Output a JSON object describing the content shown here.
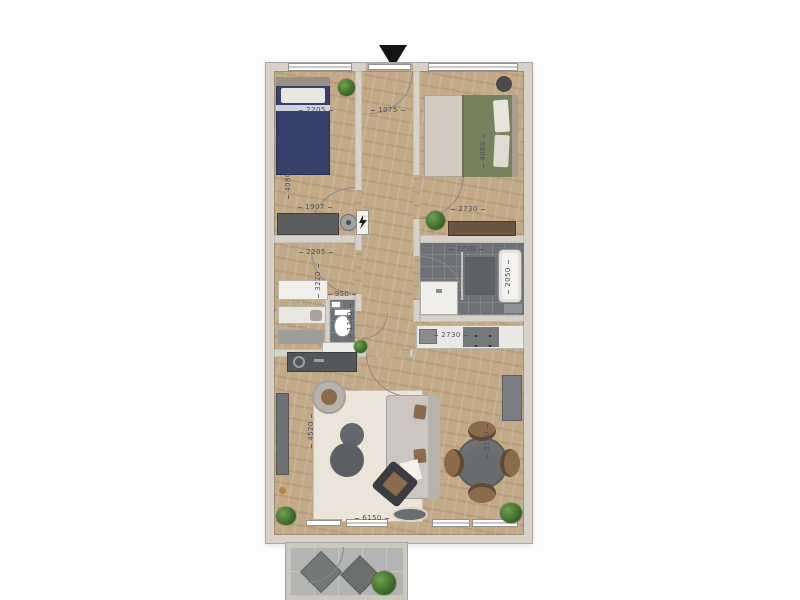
{
  "plan": {
    "title": "apartment-floor-plan",
    "dimension_labels": {
      "bedroom1_width": "2205",
      "bedroom1_depth": "4080",
      "bedroom1_desk_width": "1907",
      "hallway_width": "1075",
      "bedroom2_width": "2730",
      "bedroom2_depth": "4080",
      "utility_width": "2205",
      "utility_depth": "3220",
      "toilet_width": "950",
      "toilet_depth": "1300",
      "bathroom_width": "2730",
      "bathroom_depth": "2050",
      "kitchen_width": "2730",
      "living_width": "6150",
      "living_depth": "4520",
      "dining_depth": "3170"
    },
    "colors": {
      "wall": "#d6d2c9",
      "wood_floor": "#c2a987",
      "dark_tile": "#6e7176",
      "rug": "#ebe5d9",
      "bed_navy": "#37406a",
      "bed_green": "#77815e",
      "balcony_concrete": "#b2b5b1",
      "label_text": "#4b505a"
    }
  }
}
